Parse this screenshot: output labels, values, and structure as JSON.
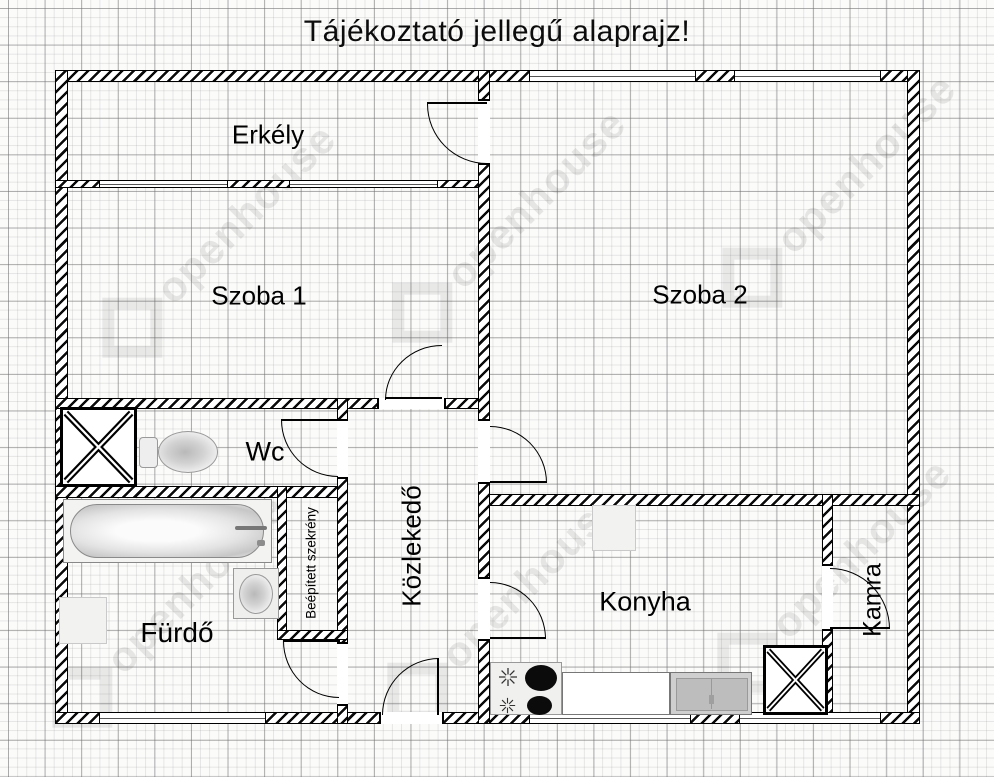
{
  "title": "Tájékoztató jellegű alaprajz!",
  "watermark": {
    "text": "openhouse"
  },
  "rooms": {
    "erkely": {
      "label": "Erkély"
    },
    "szoba1": {
      "label": "Szoba 1"
    },
    "szoba2": {
      "label": "Szoba 2"
    },
    "wc": {
      "label": "Wc"
    },
    "kozlekedo": {
      "label": "Közlekedő"
    },
    "furdo": {
      "label": "Fürdő"
    },
    "konyha": {
      "label": "Konyha"
    },
    "kamra": {
      "label": "Kamra"
    },
    "szekreny": {
      "label": "Beépített szekrény"
    }
  }
}
